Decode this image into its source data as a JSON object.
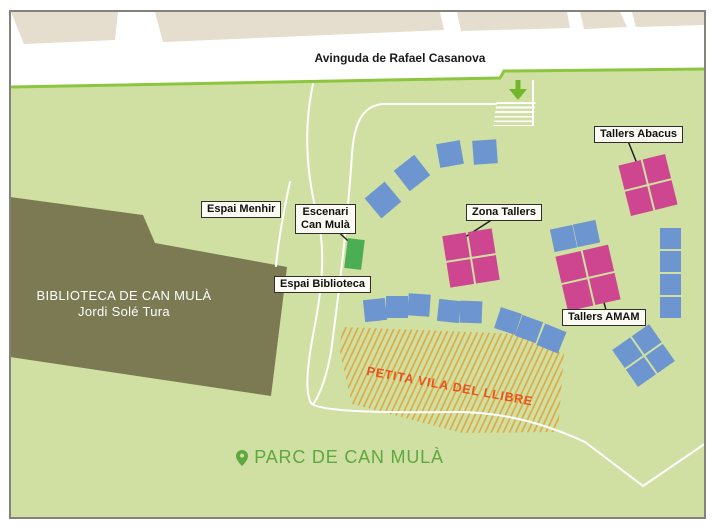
{
  "map": {
    "street": {
      "name": "Avinguda de Rafael Casanova"
    },
    "library": {
      "name": "BIBLIOTECA DE CAN MULÀ",
      "subtitle": "Jordi Solé Tura"
    },
    "labels": {
      "espai_menhir": "Espai Menhir",
      "escenari": {
        "line1": "Escenari",
        "line2": "Can Mulà"
      },
      "espai_biblioteca": "Espai Biblioteca",
      "zona_tallers": "Zona Tallers",
      "tallers_abacus": "Tallers Abacus",
      "tallers_amam": "Tallers AMAM"
    },
    "areas": {
      "petita_vila": "PETITA VILA DEL LLIBRE"
    },
    "park": {
      "name": "PARC DE CAN MULÀ"
    },
    "colors": {
      "park_fill": "#cfe0a2",
      "park_edge": "#8cc63f",
      "street": "#ffffff",
      "buildings": "#e5ddcd",
      "library_fill": "#7b7a53",
      "stage_green": "#4cae54",
      "tent_blue": "#6d95cf",
      "tent_pink": "#ce4590",
      "hatch_orange": "#dfa43c",
      "vila_text": "#e8521d",
      "park_text": "#5fa743",
      "arrow_green": "#72b62c",
      "border_gray": "#83837b"
    }
  }
}
